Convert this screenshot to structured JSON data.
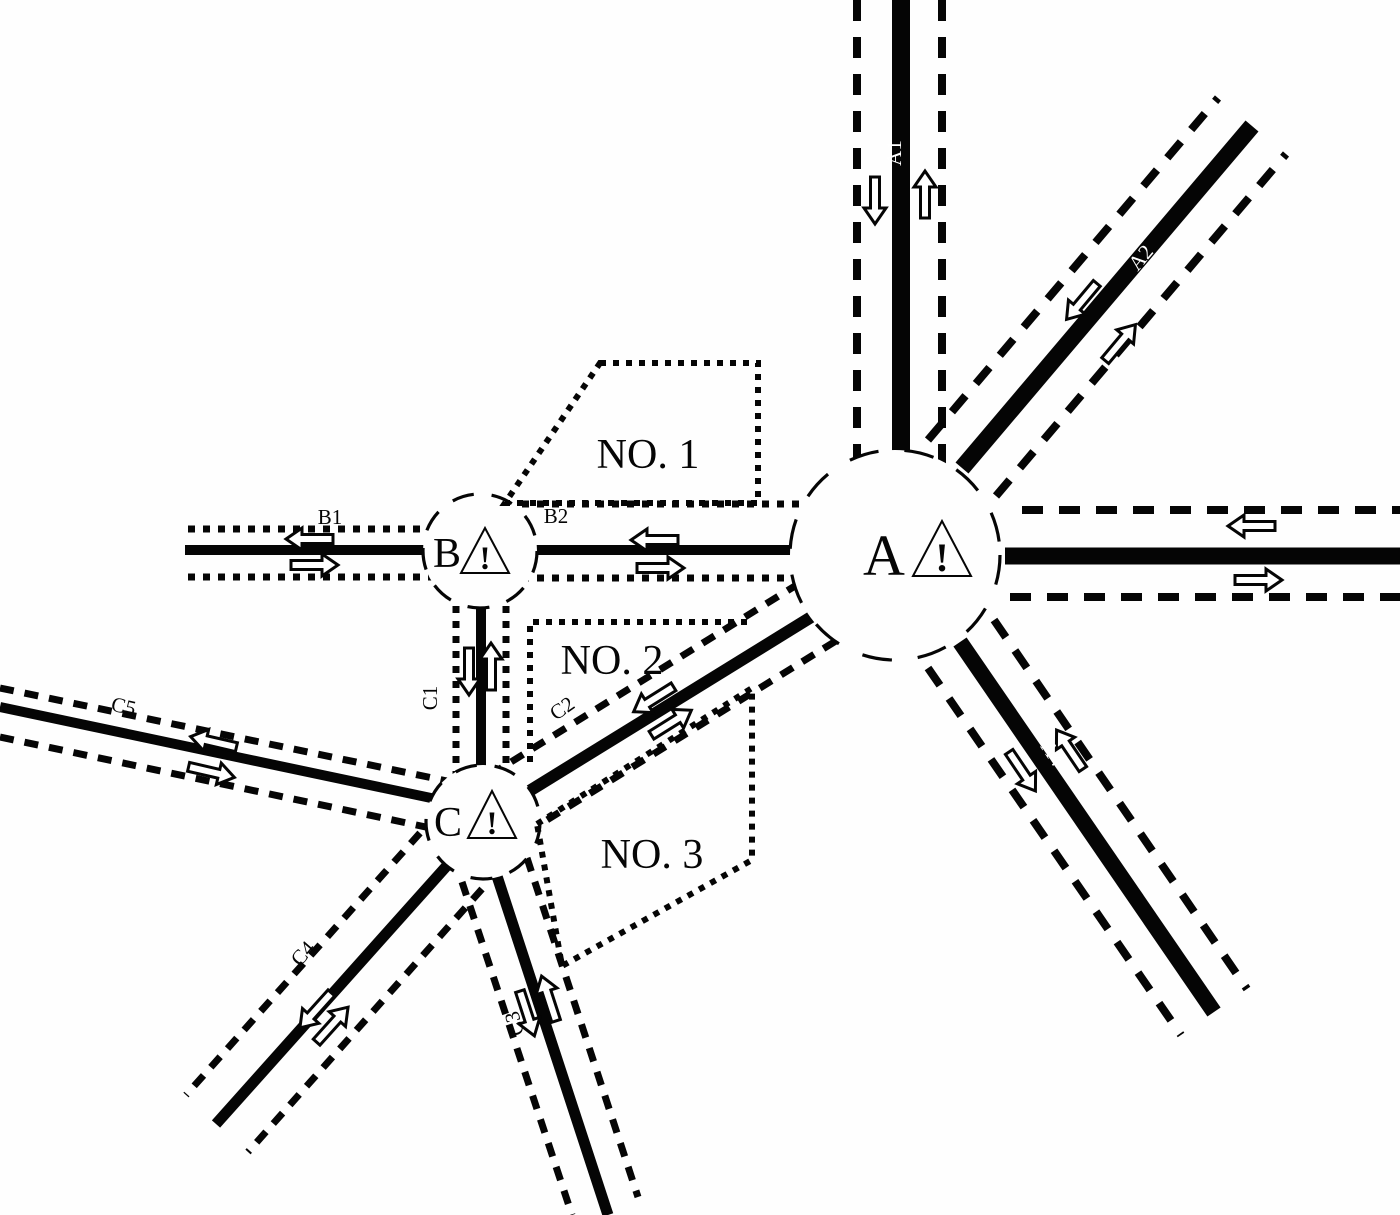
{
  "nodes": {
    "a": "A",
    "b": "B",
    "c": "C"
  },
  "warning_glyph": "!",
  "roads": {
    "a1": "A1",
    "a2": "A2",
    "a4": "A4",
    "b1": "B1",
    "b2": "B2",
    "c1": "C1",
    "c2": "C2",
    "c3": "C3",
    "c4": "C4",
    "c5": "C5"
  },
  "zones": {
    "no1": "NO. 1",
    "no2": "NO. 2",
    "no3": "NO. 3"
  },
  "colors": {
    "ink": "#050505",
    "paper": "#fefefe"
  }
}
